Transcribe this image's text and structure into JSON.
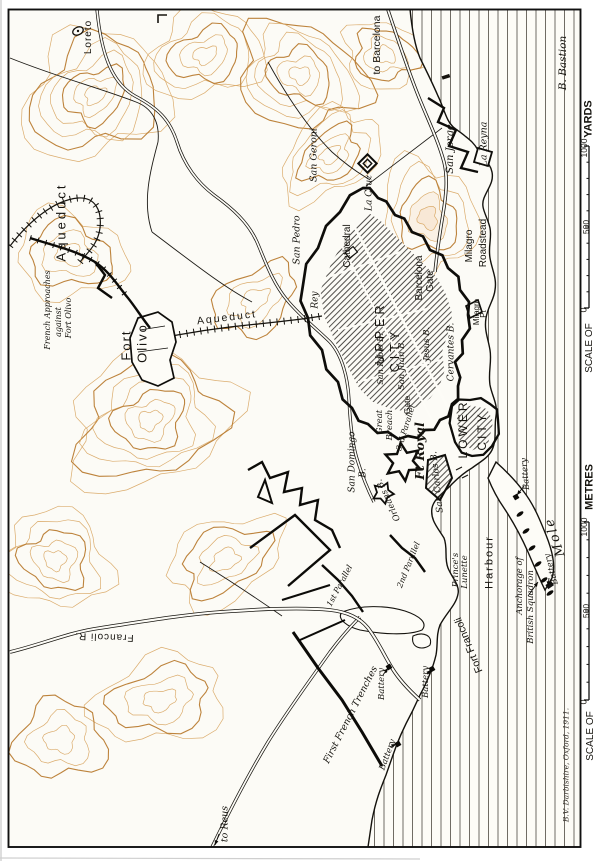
{
  "map": {
    "title_note": "Siege map of Tarragona (rotated sheet)",
    "labels": {
      "loreto": "Loreto",
      "to_barcelona": "to Barcelona",
      "b_bastion": "B. Bastion",
      "san_geroni": "San Geroni",
      "san_jorge": "San Jorge",
      "la_reyna": "La Reyna",
      "san_pedro": "San Pedro",
      "la_cruz": "La Cruz",
      "cathedral": "Cathedral",
      "aqueduct_nw": "Aqueduct",
      "aqueduct_e": "Aqueduct",
      "french_approaches_1": "French Approaches",
      "french_approaches_2": "against",
      "french_approaches_3": "Fort Olivo",
      "fort_word": "Fort",
      "olivo_word": "Olivo",
      "rey": "Rey",
      "upper": "UPPER",
      "city_upper": "CITY",
      "barcelona_word": "Barcelona",
      "gate_barcelona": "Gate",
      "milagro_word": "Milagro",
      "roadstead_word": "Roadstead",
      "milagro_pt_1": "Milagro",
      "milagro_pt_2": "Pt",
      "san_pablo": "San Pablo B.",
      "san_juan": "San Juan B.",
      "jesus": "Jesus B.",
      "cervantes": "Cervantes B.",
      "great_word": "Great",
      "breach_word": "Breach",
      "gate": "Gate",
      "parallel_3rd": "3rd Parallel",
      "ft_royal": "Ft Royal",
      "san_carlos": "San Carlos B.",
      "lower": "LOWER",
      "city_lower": "CITY",
      "san_domingo_1": "San Domingo",
      "san_domingo_2": "B.",
      "orleans": "Orleans B.",
      "parallel_2nd": "2nd Parallel",
      "parallel_1st": "1st Parallel",
      "princes_1": "Prince's",
      "princes_2": "Lunette",
      "harbour": "Harbour",
      "fort_francoli": "Fort Francoli",
      "first_french_trenches": "First French Trenches",
      "battery_1": "Battery",
      "battery_2": "Battery",
      "battery_3": "Battery",
      "battery_4": "Battery",
      "battery_5": "Battery",
      "mole": "Mole",
      "anchorage_1": "Anchorage of",
      "anchorage_2": "British Squadron",
      "francoli_r": "Francoli R.",
      "to_reus": "to Reus",
      "signature": "B.V. Darbishire, Oxford, 1911."
    },
    "scales": {
      "yards": {
        "title": "YARDS",
        "v1000": "1000",
        "v500": "500",
        "v0": "0",
        "scale_of": "SCALE OF"
      },
      "metres": {
        "title": "METRES",
        "v1000": "1000",
        "v500": "500",
        "v0": "0",
        "scale_of": "SCALE OF"
      }
    },
    "symbols": {
      "chapel": "chapel-oval-symbol",
      "ships": "british-squadron-ship-marks",
      "forts": "fort-outline-symbols"
    },
    "colors": {
      "paper": "#fcfbf6",
      "contour": "#c98a3f",
      "contour_light": "#d9a865",
      "ink": "#1a1813",
      "sea_line": "#605c54"
    }
  }
}
